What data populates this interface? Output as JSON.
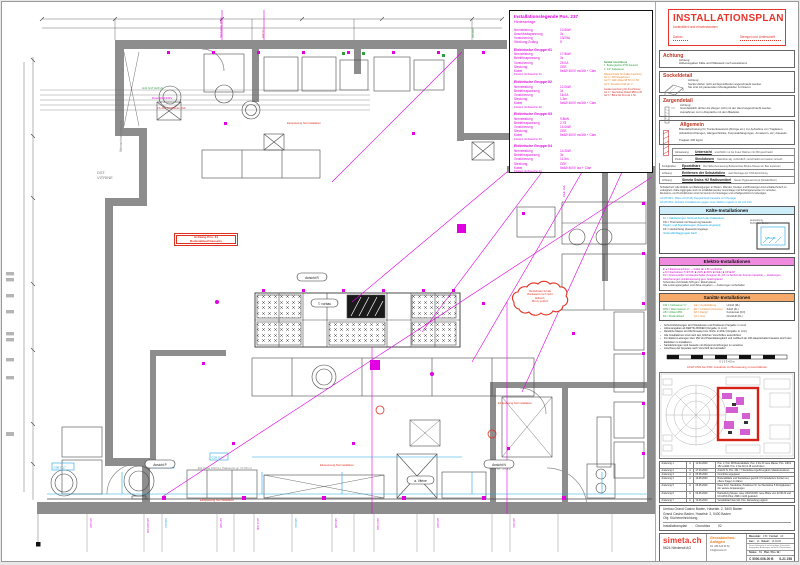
{
  "colors": {
    "accent_red": "#e8352a",
    "magenta": "#e100e1",
    "cyan": "#1fa7df",
    "orange": "#ef7f1a",
    "wall_gray": "#8d8d8d"
  },
  "plan": {
    "weinschrank": "Weinschrank gekühlt",
    "vitrine1": "DST.",
    "vitrine2": "VITRINE",
    "room": "EG-Kalte Küche | Patisserie  gr. 17.95 m²",
    "wvac1": "W.VAC",
    "wvac2": "PS. NR. 20.16",
    "ansicht_p": "Ansicht P",
    "ansicht_n": "Ansicht N",
    "ansicht_r": "Ansicht R",
    "t_vorbau": "T. vorbau",
    "a_vitrine": "a. Vitrine",
    "red_tag": "Einspeisung NA Installation",
    "warn1": "Achtung Pos. 31",
    "warn2": "Bodenablauf bauseits",
    "cloud": "Steckdosen für die\nRückwand noch nicht\ndefiniert.\nMit zu prüfen!",
    "leader1": "G41 G17 G20 2x",
    "leader2": "Dose NR4 230V",
    "leader3": "FS 400 Steckdose 16A",
    "top1": "Steckdose 400V",
    "top2": "KW ½\"",
    "top3": "AB Ø50",
    "top4": "CEE 16A",
    "cyanbox1": "G08 G13",
    "cyanbox2": "G26 G34",
    "cyanbox3": "G00 G17",
    "bottom_labels": [
      "G41 G20",
      "G13 G20 G19",
      "G17 G28",
      "G44.1 G08",
      "G30 G08",
      "G12.2 G48",
      "G40 G20",
      "G04 G34"
    ]
  },
  "legend": {
    "title": "Installationslegende Pos. 237",
    "subtitle": "Hinteranlage",
    "intro_labels": "Nennleistung\nAnschlussspannung\nVorsicherung\nSteckung Zuläng",
    "intro_values": "10.5kW\n3x\n13/25A\n5",
    "g1_title": "Elektrische Gruppe 01",
    "g1_labels": "Nennleistung\nBetriebsspannung\nVorsicherung\nSteckung\nKabel",
    "g1_values": "17.5kW\n3x\n25.0A\nCEE\n5x6Ø 400V m²/16t + Clan",
    "g1_note": "Position Verbraucher 01",
    "g2_title": "Elektrische Gruppe 02",
    "g2_values": "12.0kW\n3x\n16.0A\n1.3m\n5x6Ø 400V m²/16t + Clan",
    "g2_note": "Position Verbraucher 02",
    "g3_title": "Elektrische Gruppe 03",
    "g3_values": "9.8kW\n2.75\n14.0kW\nCEE\n5x6Ø 400V m²/16t + Clan",
    "g3_note": "Position Verbraucher 03",
    "g4_title": "Elektrische Gruppe 04",
    "g4_values": "14.2kW\n3x\n11.5m\nCEE\n5x6Ø 400V Iso + Clan",
    "g4_note": "Position Verbraucher 04",
    "san_title": "Sanitär Anschlüsse",
    "san_lines": "1. Bodengleiche Ø 50 bauseits\n2. 1/2\" Kaltwasser",
    "orange_lines": "Wasserzufuhr für Kaffeemaschine:\nG1  ¾\" KW Steckdosen\nG2  ½\" GEF Ablauf Ø 50 m 1.50\nG3  1\" Druckfest KW ab ¾\"",
    "red_lines": "Gerätezuordnung für Anschlüsse:\nG1  ¾\" Steckdose Ablauf Ø50 2.20\nG2  ¾\" Blind bis 30 A ab 1.50"
  },
  "titlebox": {
    "title": "INSTALLATIONSPLAN",
    "subtitle": "kontrolliert und einverstanden",
    "date_label": "Datum",
    "stamp_label": "Stempel und Unterschrift"
  },
  "sections": {
    "achtung_header": "Achtung",
    "achtung_text": "Achtung:\nHöhenangaben Kälte und Plättewerk noch ausstehend.",
    "sockel_header": "Sockeldetail",
    "sockel_text": "Achtung:\nSockel dürfen nicht auf Epoxidböden angeschraubt werden.\nSie sind mit passendem Montagekleber zu fixieren.",
    "zargen_header": "Zargendetail",
    "zargen_text": "Achtung:\nGrundsätzlich dürfen die Zargen nicht mit der Hand angeschraubt werden.\nAusnahmen nur in Absprache mit dem Bauleiter.",
    "allg_header": "Allgemein",
    "allg_text": "Brandabschottung für Trockenbauwand (Abzüge etc.) zur Aufnahme von Traglasten (Abstellvorrichtungen, Hängeschränke, Korpusabhängungen, Armaturen, etc.) bauseits.\n\nTraglast: 200 kg/m²"
  },
  "hints": [
    {
      "label": "Hinweisung:",
      "term": "Untersicht",
      "text": "ersichtlich nur bei freien Flächen mit 300 geschraubt"
    },
    {
      "label": "Punkt:",
      "term": "Steckdosen",
      "text": "Standorte alg. verbindlich, verschraubt und sauber versetzt"
    },
    {
      "label": "Fertigböden:",
      "term": "Epoxidharz",
      "text": "Bei Höhenbemassung Bodeneinbau Boden-Niveau am Bau anpassen"
    },
    {
      "label": "Achtung:",
      "term": "Entfernen der Schutzfolien",
      "text": "nach Montage der CNS-Einrichtung"
    },
    {
      "label": "Achtung:",
      "term": "Simeta Swiss H2 Radiusmöbel",
      "text": "Neues Hygienekonzept (Details/Werk)"
    }
  ],
  "para": "Schallschutz: Alle Abläufe und Befestigungen an Boden, Wänden, Decken und Brüstungen sind schalltechnisch zu entkoppeln. Kälte-Aggregate sind mit schalldämmender Gummilage und Schwingelementen zu versehen.\nRevisions- und Technikfronten sind mit Gummi zu hinterlegen und schallgeschützt zu befestigen.",
  "cyan1": "ACHTUNG: Pläne A0 (P+B) Doppelcheck bauseits vor Montage.",
  "cyan2": "ACHTUNG: Aktuelle Installationen gegen neue Stellen ergänzt in 02 und 010.",
  "kaelte": {
    "header": "Kälte-Installationen",
    "l1": "KL = Kälteleitungen Verbund durch den Kälteplaner",
    "l2": "KD = Thermostat mit Steuerung bauseits",
    "l3": "Regler- und Signalleitungen (bauseits eingelegt)",
    "l4": "KZ = steckerfertig (bauseits) angelegt",
    "l5": "Verbundkühlaggregate Dach",
    "diagram_label1": "Aussparung",
    "diagram_label2": "Kühlzellen-Decke",
    "diagram_label3": "Kühlzelle"
  },
  "elektro": {
    "header": "Elektro-Installationen",
    "l1": "E ● = Elektroanschluss — Kabel ab 1.50 verdrahtet",
    "l2": "● KV-Steckdosen T13/T25:  ■ 230V  ■ 400V  ■ CEE  |  ■ UP  ■ AP",
    "l3": "KV = Kleinverteiler mit Hauptschalter (Gruppen 01–04, im Sockel der Fronten bauseits) — Zuleitungen, Absicherungen und Einspeisung gem. Elektroplaner",
    "l4": "Schemata und Details NIN gem. Elektroplaner",
    "l5": "Alle Leistungsangaben sind Zirka-Angaben — Änderungen vorbehalten"
  },
  "sanitaer": {
    "header": "Sanitär-Installationen",
    "col1": "KW = Kaltwasser ½\"\nWW = Warmwasser ¾\"\nAB = Ablauf Ø50\nBA = Bodenablauf",
    "col2": "GE = Gerätefüllung\nEN = enthärtet (Osmose)\nDA = Dampf\nGA = Gas",
    "col3": "Umluft (RL)\nZuluft (ZL)\nKondensat (KO)\nDruckluft (DL)"
  },
  "bullets": [
    "Schutzrohrleitungen sind Steckdosen und Positionen (Vergabe: in mm²)",
    "Höhenangaben ab FERTIG BODEN (Vergabe: in mm²)",
    "Restliche Masse sind Richtmasse bzw. Richt- in ROH (Vergabe: in mm²)",
    "Alle Installationen sind nach den örtlichen Vorschriften auszuführen",
    "Für Elektro-Leitungen über 150 sind Potentialausgleich und Leitblech ab 100-Hauptschalter bauseits durch den Elektriker zu installieren",
    "Sanitärleitungen sind bauseits mit Absperrvorrichtungen zu versehen",
    "Anschluss der Apparate nach Vorschrift der Hersteller"
  ],
  "scale_ticks": "0      1      2      3      4      5 m",
  "scale_caption": "ACHTUNG bei PDF: Ausdruck mit Bemassung zu kontrollieren",
  "revisions": [
    {
      "n": "Änderung 1",
      "i": "A",
      "d": "10.04.2020",
      "t": "Pos. 2, Pos. 88 Bodenabläufe; Pos. 3 bis 23 neue Masse; Pos. 148 & 152 entfällt; Pos. 2 bis 210 & 18 verschoben"
    },
    {
      "n": "Änderung 2",
      "i": "A",
      "d": "17.04.2020",
      "t": "Ansicht N, Pos. 431 / 7 Steckdose CgeS3 ergänzt; Masskorrekturen"
    },
    {
      "n": "Änderung 3",
      "i": "A",
      "d": "05.05.2020",
      "t": "Grundriss angepasst"
    },
    {
      "n": "Änderung 4",
      "i": "A",
      "d": "19.05.2020",
      "t": "Bodenabläufe und Steckdosen geprüft; KV-Verteilerbox Sockel neu; offene Fragen zu klären"
    },
    {
      "n": "Änderung 5",
      "i": "A",
      "d": "26.05.2020",
      "t": "Neue Kont. Steckdose; Positionen Nr. bei Steckdose 5 Abzugsleisten; div. weitere Anpassungen"
    },
    {
      "n": "Änderung 6",
      "i": "A",
      "d": "03.06.2020",
      "t": "Darstellung Niveau; neue UK2/UK200; neue Pläne vom 22.06.20 und UK-M/UK-Plus; ZAB in GAS geändert"
    },
    {
      "n": "Änderung 7",
      "i": "A",
      "d": "10.06.2020",
      "t": "Verteilablauf Gas inkl. Pos. Darstellung ergänzt"
    }
  ],
  "project": {
    "l1": "Umbau Grand Casino Baden, Haselstr. 2, 5400 Baden",
    "l2": "Grand Casino Baden, Haselstr. 2, 5400 Baden",
    "l3": "Obj: Kücheneinrichtung",
    "doc": "Installationsplan",
    "doc2": "Grundriss",
    "doc3": "02"
  },
  "footer": {
    "logo": "simeta.ch",
    "addr": "5624 Niederwil AG",
    "dept": "Grossküchen-Anlagen",
    "tel": "Tel. 056 619 62 62",
    "mail": "info@simeta.ch",
    "m_label": "Massstab:",
    "m_val": "1:50",
    "f_label": "Format:",
    "f_val": "A0",
    "g_label": "Gez.:",
    "g_val": "sb",
    "d_label": "Datum:",
    "d_val": "14.04.20",
    "note": "Dieses Dokument ist nur mit gültiger Unterschrift freigegeben. Änderungen nur durch Planverfasser.",
    "status_label": "Status:",
    "status_val": "B1",
    "plan_label": "Plan / Pos. Nr.:",
    "plan_no": "C 5000-006-00  B",
    "plan_extra": "S-21 258"
  }
}
